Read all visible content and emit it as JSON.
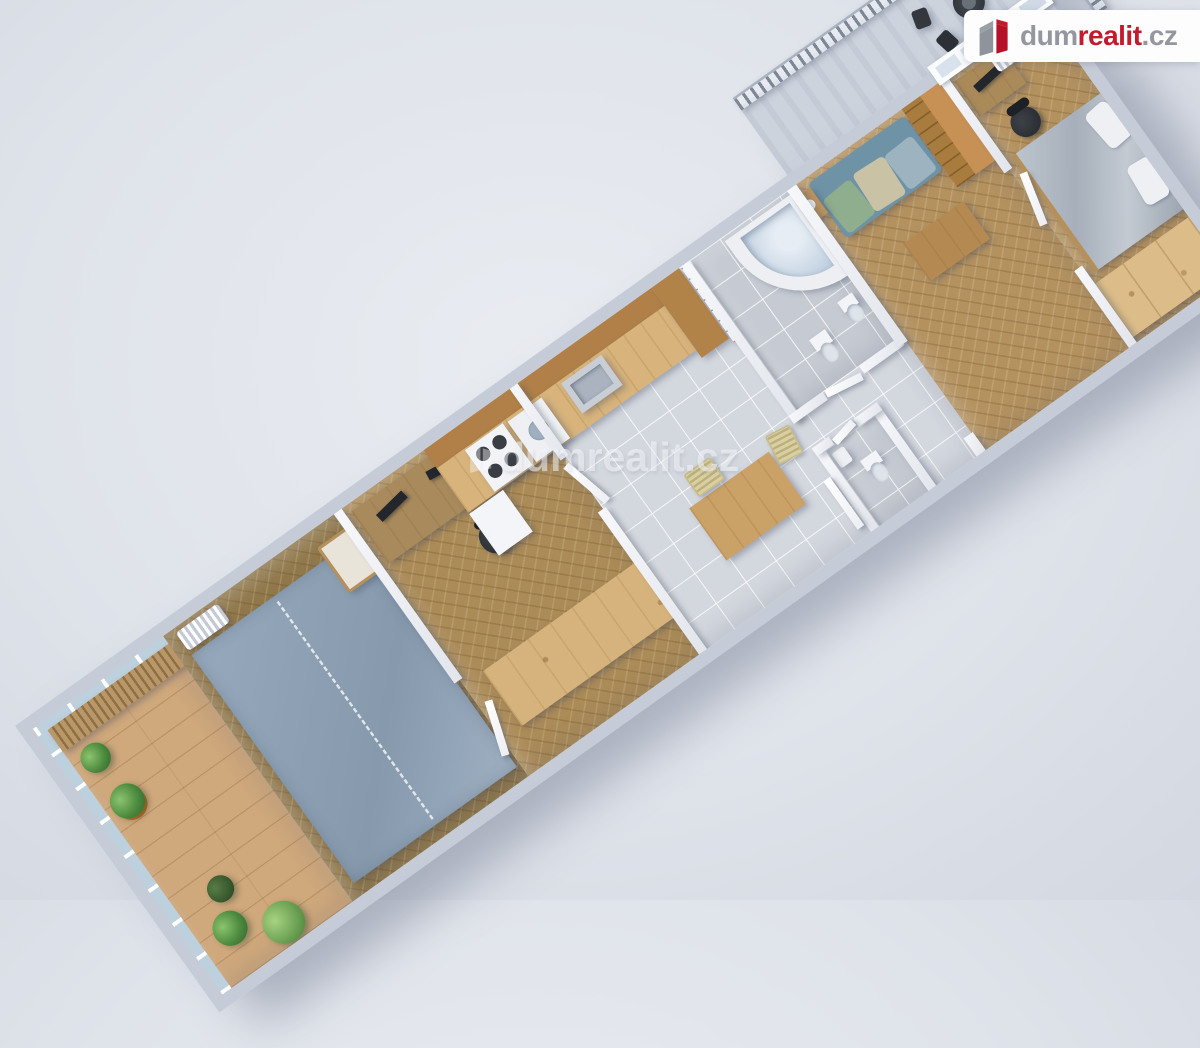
{
  "meta": {
    "image_type": "3d-floorplan-render",
    "background_color": "#dfe3ea",
    "accent_red": "#c21b2d",
    "wall_color": "#c6ccd7"
  },
  "branding": {
    "logo": {
      "prefix": "dum",
      "highlight": "realit",
      "suffix": ".cz",
      "prefix_color": "#94979e",
      "highlight_color": "#c21b2d",
      "icon": "dumrealit-cube-icon"
    }
  },
  "watermark": {
    "text": "dumrealit.cz"
  },
  "floorplan": {
    "projection": "rotated top-down 3d render",
    "rotation_deg": -35.5,
    "rooms": [
      {
        "name": "winter-garden",
        "floor": "wood-planks",
        "features": [
          "glazed-walls",
          "potted-plants",
          "bench-shelf"
        ]
      },
      {
        "name": "bedroom-2",
        "floor": "parquet",
        "features": [
          "blue-gray-carpet",
          "radiator",
          "armchair"
        ]
      },
      {
        "name": "study",
        "floor": "herringbone-parquet",
        "features": [
          "desk",
          "two-monitors",
          "office-chair",
          "long-sideboard"
        ]
      },
      {
        "name": "kitchen-dining",
        "floor": "gray-tile",
        "features": [
          "wall-cabinets",
          "counter",
          "gas-stove",
          "washing-machine",
          "sink",
          "fridge",
          "tall-cabinet",
          "white-shelf-unit",
          "dark-cabinet",
          "dining-table",
          "two-chairs"
        ]
      },
      {
        "name": "bathroom",
        "floor": "gray-tile",
        "features": [
          "corner-bathtub",
          "toilet",
          "bidet"
        ]
      },
      {
        "name": "wc",
        "floor": "gray-tile",
        "features": [
          "toilet",
          "hand-basin"
        ]
      },
      {
        "name": "hallway",
        "floor": "gray-tile",
        "features": [
          "open-doors"
        ]
      },
      {
        "name": "living-room",
        "floor": "herringbone-parquet",
        "features": [
          "patterned-sofa",
          "side-table-flower",
          "coffee-table",
          "shelf-wardrobe-unit",
          "balcony-door"
        ]
      },
      {
        "name": "bedroom-1",
        "floor": "herringbone-parquet",
        "features": [
          "double-bed",
          "pillows",
          "long-wardrobe",
          "desk",
          "office-chair",
          "radiator",
          "window"
        ]
      },
      {
        "name": "balcony",
        "floor": "tile",
        "features": [
          "slat-railing",
          "bistro-table",
          "two-chairs"
        ]
      }
    ],
    "palette": {
      "wood_light": "#d8b47c",
      "wood_mid": "#b49260",
      "wood_dark": "#7c3a20",
      "carpet": "#8fa2b6",
      "tile": "#d3d7de",
      "bed_cover": "#aeb7c1",
      "sofa": "#7fa3b5"
    }
  }
}
